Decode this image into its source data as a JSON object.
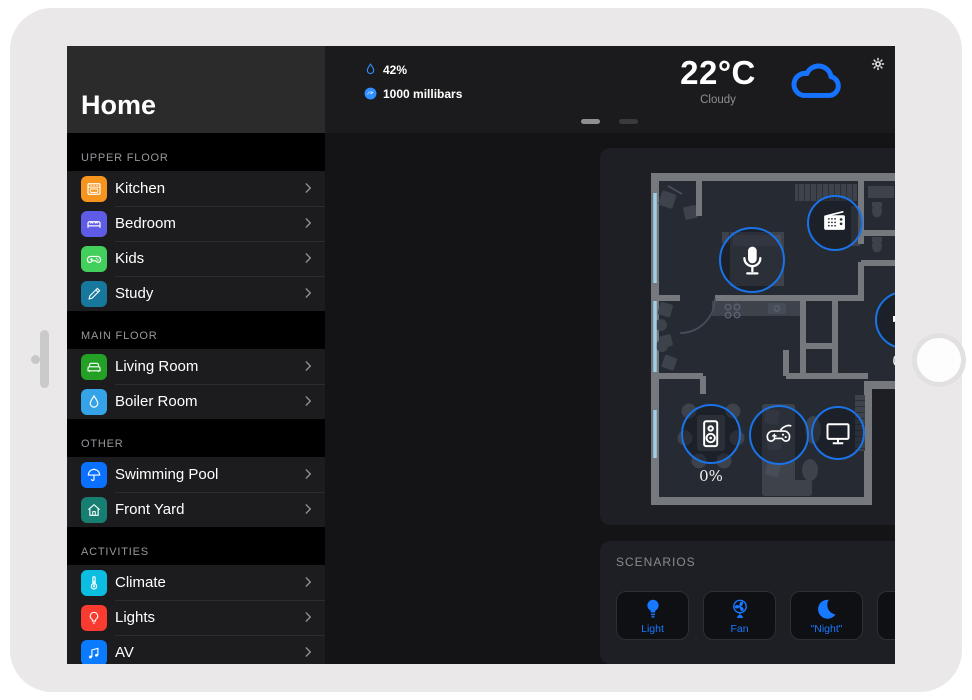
{
  "sidebar": {
    "title": "Home",
    "sections": [
      {
        "label": "UPPER FLOOR",
        "items": [
          {
            "label": "Kitchen",
            "icon": "stove-icon",
            "color": "#f7941e"
          },
          {
            "label": "Bedroom",
            "icon": "bed-icon",
            "color": "#5e5ce6"
          },
          {
            "label": "Kids",
            "icon": "gamepad-icon",
            "color": "#43cf5c"
          },
          {
            "label": "Study",
            "icon": "pencil-icon",
            "color": "#17789e"
          }
        ]
      },
      {
        "label": "MAIN FLOOR",
        "items": [
          {
            "label": "Living Room",
            "icon": "sofa-icon",
            "color": "#23a127"
          },
          {
            "label": "Boiler Room",
            "icon": "drop-icon",
            "color": "#35a3e8"
          }
        ]
      },
      {
        "label": "OTHER",
        "items": [
          {
            "label": "Swimming Pool",
            "icon": "umbrella-icon",
            "color": "#0a70ff"
          },
          {
            "label": "Front Yard",
            "icon": "house-icon",
            "color": "#177f72"
          }
        ]
      },
      {
        "label": "ACTIVITIES",
        "items": [
          {
            "label": "Climate",
            "icon": "thermometer-icon",
            "color": "#0bbde0"
          },
          {
            "label": "Lights",
            "icon": "bulb-icon",
            "color": "#fa3b30"
          },
          {
            "label": "AV",
            "icon": "music-notes-icon",
            "color": "#0a7aff"
          }
        ]
      }
    ]
  },
  "topbar": {
    "humidity": {
      "value": "42%",
      "icon": "humidity-drop-icon"
    },
    "pressure": {
      "value": "1000 millibars",
      "icon": "pressure-gauge-icon"
    },
    "temperature": "22°C",
    "condition": "Cloudy",
    "weather_icon": "cloud-icon",
    "settings_icon": "gear-icon"
  },
  "floorplan": {
    "devices": [
      {
        "name": "radio",
        "icon": "radio-icon",
        "x": 235,
        "y": 75,
        "size": 56
      },
      {
        "name": "microphone",
        "icon": "microphone-icon",
        "x": 152,
        "y": 112,
        "size": 66
      },
      {
        "name": "media-player",
        "icon": "music-tv-icon",
        "x": 429,
        "y": 82,
        "size": 54
      },
      {
        "name": "audio-volume",
        "icon": "speaker-wave-icon",
        "x": 304,
        "y": 172,
        "size": 58,
        "label": "0%"
      },
      {
        "name": "speaker",
        "icon": "speaker-box-icon",
        "x": 111,
        "y": 286,
        "size": 60,
        "label": "0%"
      },
      {
        "name": "game-console",
        "icon": "gamepad-cable-icon",
        "x": 179,
        "y": 287,
        "size": 60
      },
      {
        "name": "tv",
        "icon": "tv-icon",
        "x": 238,
        "y": 285,
        "size": 54
      }
    ]
  },
  "scenarios": {
    "label": "SCENARIOS",
    "buttons": [
      {
        "label": "Light",
        "icon": "bulb-fill-icon"
      },
      {
        "label": "Fan",
        "icon": "fan-icon"
      },
      {
        "label": "\"Night\"",
        "icon": "moon-icon"
      },
      {
        "label": "Sockets",
        "icon": "power-icon"
      },
      {
        "label": "Floor Heat",
        "icon": "dots-grid-icon"
      },
      {
        "label": "Clock",
        "icon": "alarm-clock-icon"
      }
    ]
  },
  "colors": {
    "accent": "#1779ff",
    "device_ring": "#1a73e8",
    "cloud": "#1673ff"
  }
}
